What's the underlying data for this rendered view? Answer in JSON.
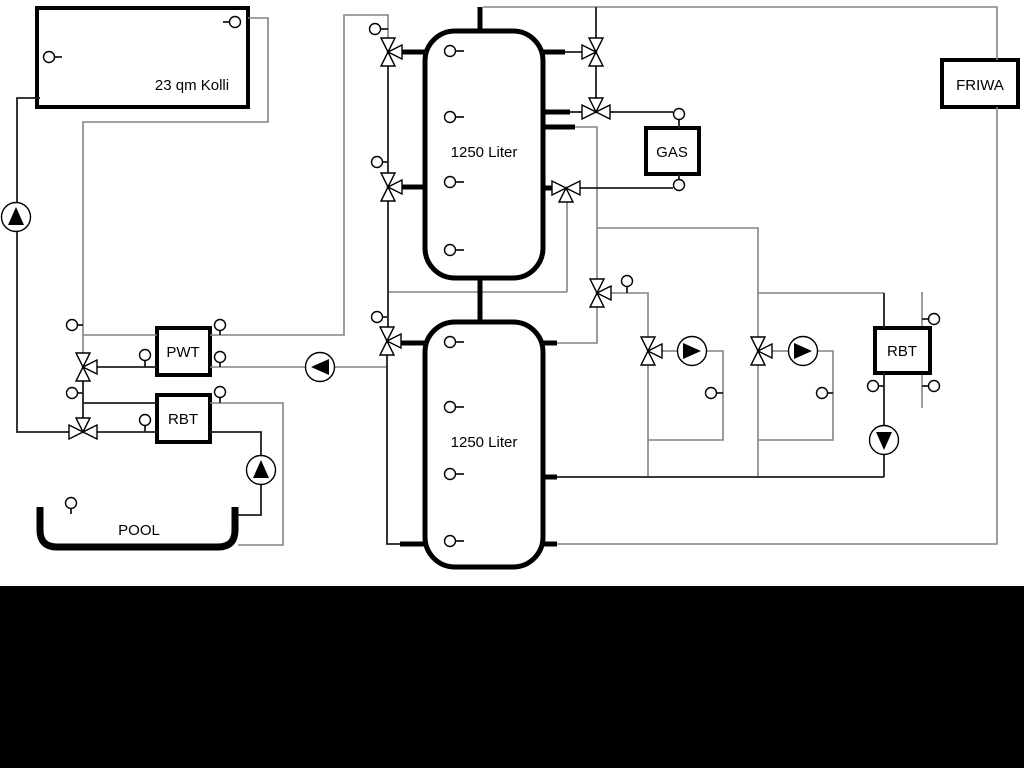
{
  "page": {
    "background": "#ffffff",
    "letterbox_color": "#000000"
  },
  "labels": {
    "collector": "23 qm Kolli",
    "buffer_tank_top": "1250 Liter",
    "buffer_tank_bottom": "1250 Liter",
    "gas_boiler": "GAS",
    "friwa_station": "FRIWA",
    "pwt_heat_exchanger": "PWT",
    "rbt_pool": "RBT",
    "rbt_heating": "RBT",
    "pool": "POOL"
  },
  "colors": {
    "pipe_grey": "#848484",
    "pipe_dark": "#1f1f1f",
    "symbol_stroke": "#000000",
    "component_fill": "#ffffff"
  },
  "components": {
    "three_way_valves": 11,
    "pumps": 6,
    "temperature_sensors": 29,
    "buffer_tanks": 2
  }
}
